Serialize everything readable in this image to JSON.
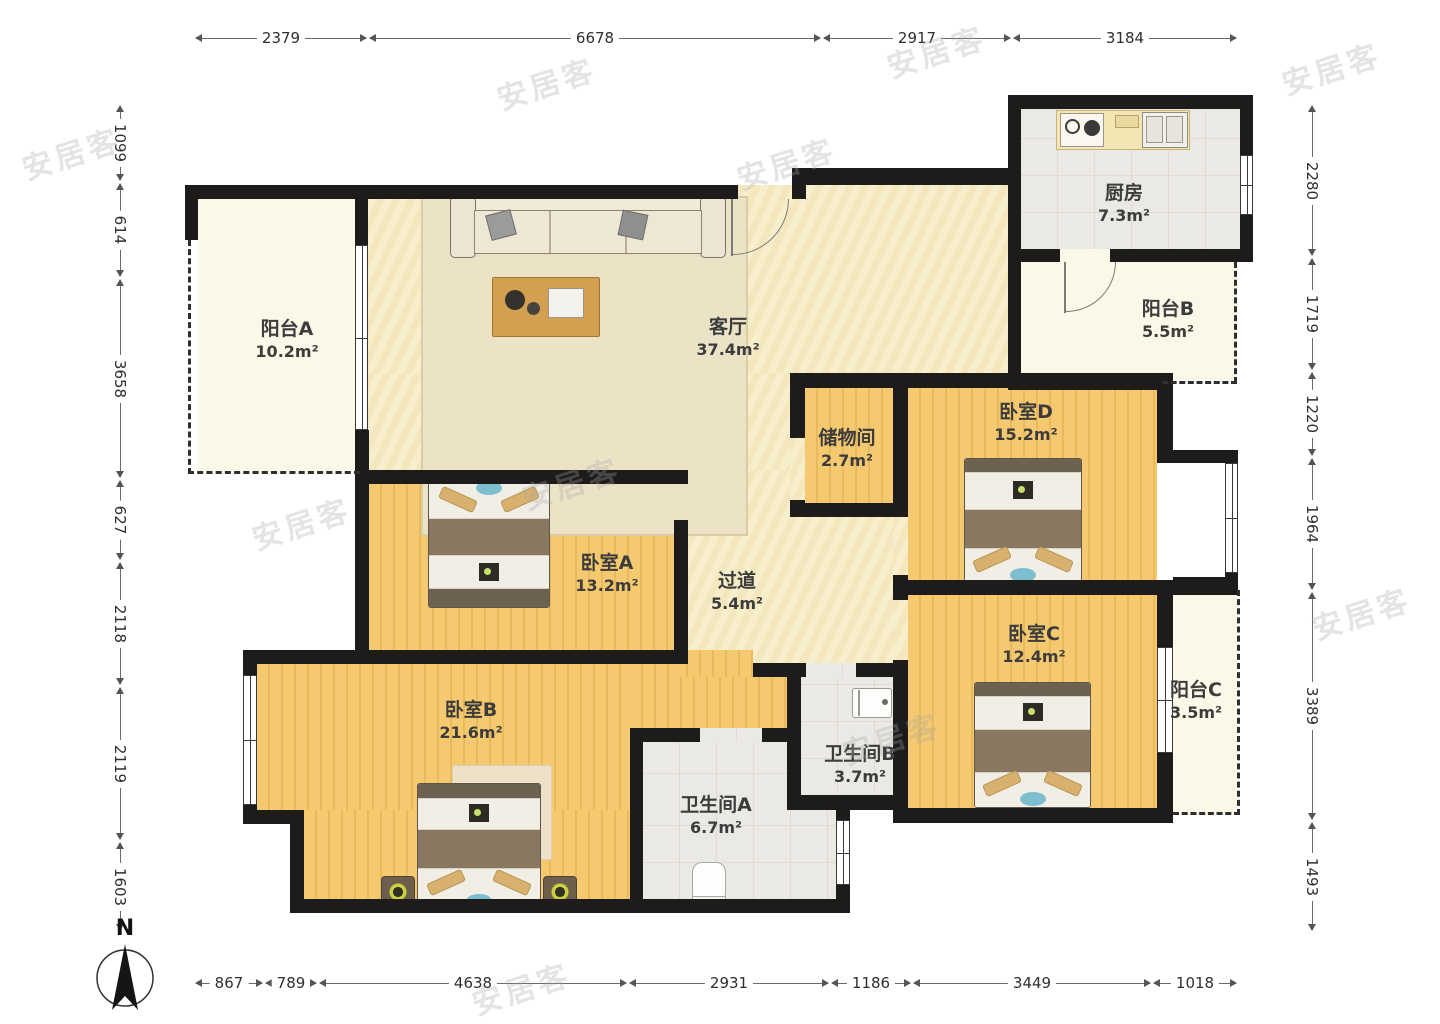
{
  "compass": {
    "label": "N"
  },
  "watermark": {
    "text": "安居客"
  },
  "rooms": {
    "balcony_a": {
      "name": "阳台A",
      "area": "10.2m²"
    },
    "living": {
      "name": "客厅",
      "area": "37.4m²"
    },
    "kitchen": {
      "name": "厨房",
      "area": "7.3m²"
    },
    "balcony_b": {
      "name": "阳台B",
      "area": "5.5m²"
    },
    "storage": {
      "name": "储物间",
      "area": "2.7m²"
    },
    "bedroom_d": {
      "name": "卧室D",
      "area": "15.2m²"
    },
    "bedroom_a": {
      "name": "卧室A",
      "area": "13.2m²"
    },
    "hallway": {
      "name": "过道",
      "area": "5.4m²"
    },
    "bedroom_c": {
      "name": "卧室C",
      "area": "12.4m²"
    },
    "balcony_c": {
      "name": "阳台C",
      "area": "3.5m²"
    },
    "bedroom_b": {
      "name": "卧室B",
      "area": "21.6m²"
    },
    "bath_a": {
      "name": "卫生间A",
      "area": "6.7m²"
    },
    "bath_b": {
      "name": "卫生间B",
      "area": "3.7m²"
    }
  },
  "dimensions": {
    "top": [
      "2379",
      "6678",
      "2917",
      "3184"
    ],
    "bottom": [
      "867",
      "789",
      "4638",
      "2931",
      "1186",
      "3449",
      "1018"
    ],
    "left": [
      "1099",
      "614",
      "3658",
      "627",
      "2118",
      "2119",
      "1603"
    ],
    "right": [
      "2280",
      "1719",
      "1220",
      "1964",
      "3389",
      "1493"
    ]
  },
  "colors": {
    "wall": "#1d1c1a",
    "wood": "#f2c469",
    "cream": "#f7eecb",
    "tile": "#ebe9e4",
    "balcony": "#fbf8e8"
  }
}
